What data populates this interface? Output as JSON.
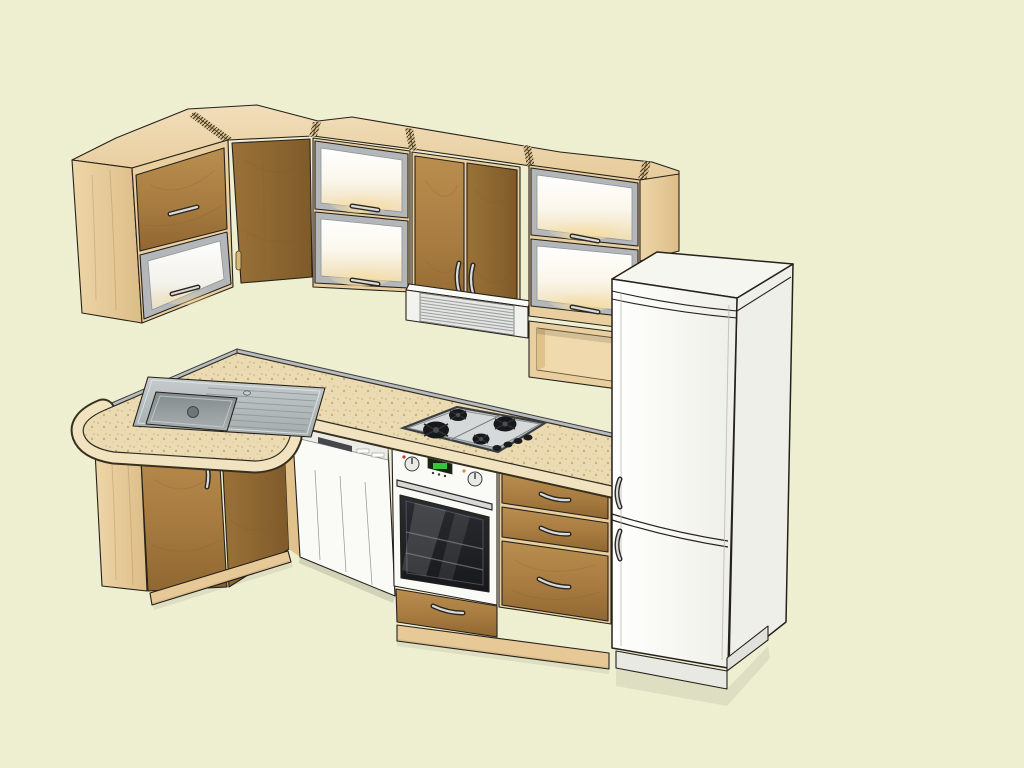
{
  "meta": {
    "description": "3D perspective render of an L-shaped fitted kitchen with corner wall cabinets, illuminated frosted-glass wall cabinets, slide-out range hood, open shelf, tall white fridge-freezer, sink peninsula with rounded end, corner base cabinet, built-under dishwasher, built-in oven, 4-burner gas cooktop and a three-drawer base unit",
    "view": "three-quarter elevated perspective",
    "visible_text": ""
  },
  "colors": {
    "background": "#f1f2d4",
    "background_texture": "#dfe1ba",
    "outline": "#26211a",
    "carcass_wood": "#e9cfa0",
    "carcass_wood_dark": "#dcbd86",
    "carcass_wood_light": "#f2ddb5",
    "door_wood": "#a87c41",
    "door_wood_dark": "#8e6530",
    "door_wood_light": "#bb8f51",
    "countertop": "#eeddb4",
    "countertop_speckle": "#d2b47f",
    "backsplash_gray": "#b9bcbe",
    "aluminum_frame": "#b3b7ba",
    "frame_light": "#d7dadc",
    "glass_warm_glow": "#f0dcae",
    "appliance_white": "#fafaf7",
    "appliance_shade": "#ebebe5",
    "steel": "#b7bdbf",
    "steel_dark": "#8d9496",
    "cooktop_panel": "#cccfd0",
    "burner_black": "#17181a",
    "oven_glass": "#1d1f22",
    "display_green": "#35c53d",
    "display_green_bg": "#13240f",
    "handle_metal": "#d9dadb",
    "hood_white": "#f2f2ee",
    "plinth_wood": "#e6c996",
    "wood_handle": "#d9b978",
    "indicator_red": "#c43b2f",
    "indicator_orange": "#d98b2b"
  },
  "scene": {
    "wall_units": [
      {
        "name": "wall-cabinet-left",
        "doors": [
          "wood panel door",
          "frosted glass lift door"
        ],
        "handles": 2
      },
      {
        "name": "wall-cabinet-corner",
        "doors": [
          "angled wood door"
        ],
        "handles": 1
      },
      {
        "name": "wall-cabinet-glass-left",
        "doors": [
          "frosted glass lift door",
          "frosted glass lift door"
        ],
        "interior_light": true
      },
      {
        "name": "wall-cabinet-double-door",
        "doors": [
          "wood door",
          "wood door"
        ],
        "handles": 2
      },
      {
        "name": "wall-cabinet-glass-right",
        "doors": [
          "frosted glass lift door",
          "frosted glass lift door"
        ],
        "interior_light": true
      },
      {
        "name": "open-shelf-unit",
        "doors": []
      }
    ],
    "appliances": [
      {
        "name": "range-hood",
        "type": "slide-out visor hood with louvered vent",
        "color": "white"
      },
      {
        "name": "refrigerator",
        "type": "freestanding fridge-freezer",
        "doors": 2,
        "handles": 2,
        "color": "white"
      },
      {
        "name": "dishwasher",
        "type": "built-under",
        "color": "white",
        "controls": "top strip with recessed handle"
      },
      {
        "name": "oven",
        "type": "built-in single oven",
        "knobs": 2,
        "display": "green LED",
        "window": "dark glass with handle bar"
      },
      {
        "name": "cooktop",
        "type": "gas",
        "burners": 4,
        "control_knobs": 4
      },
      {
        "name": "sink",
        "type": "inset bowl with ribbed drainer",
        "material": "stainless steel"
      }
    ],
    "base_units": [
      {
        "name": "base-corner-cabinet",
        "doors": 2,
        "handles": 2
      },
      {
        "name": "oven-housing-drawer",
        "drawers": 1
      },
      {
        "name": "drawer-unit",
        "drawers": 3,
        "handles": 3
      }
    ],
    "worktop": {
      "shape": "L with rounded peninsula end",
      "backsplash": "grey upstand strip"
    }
  }
}
